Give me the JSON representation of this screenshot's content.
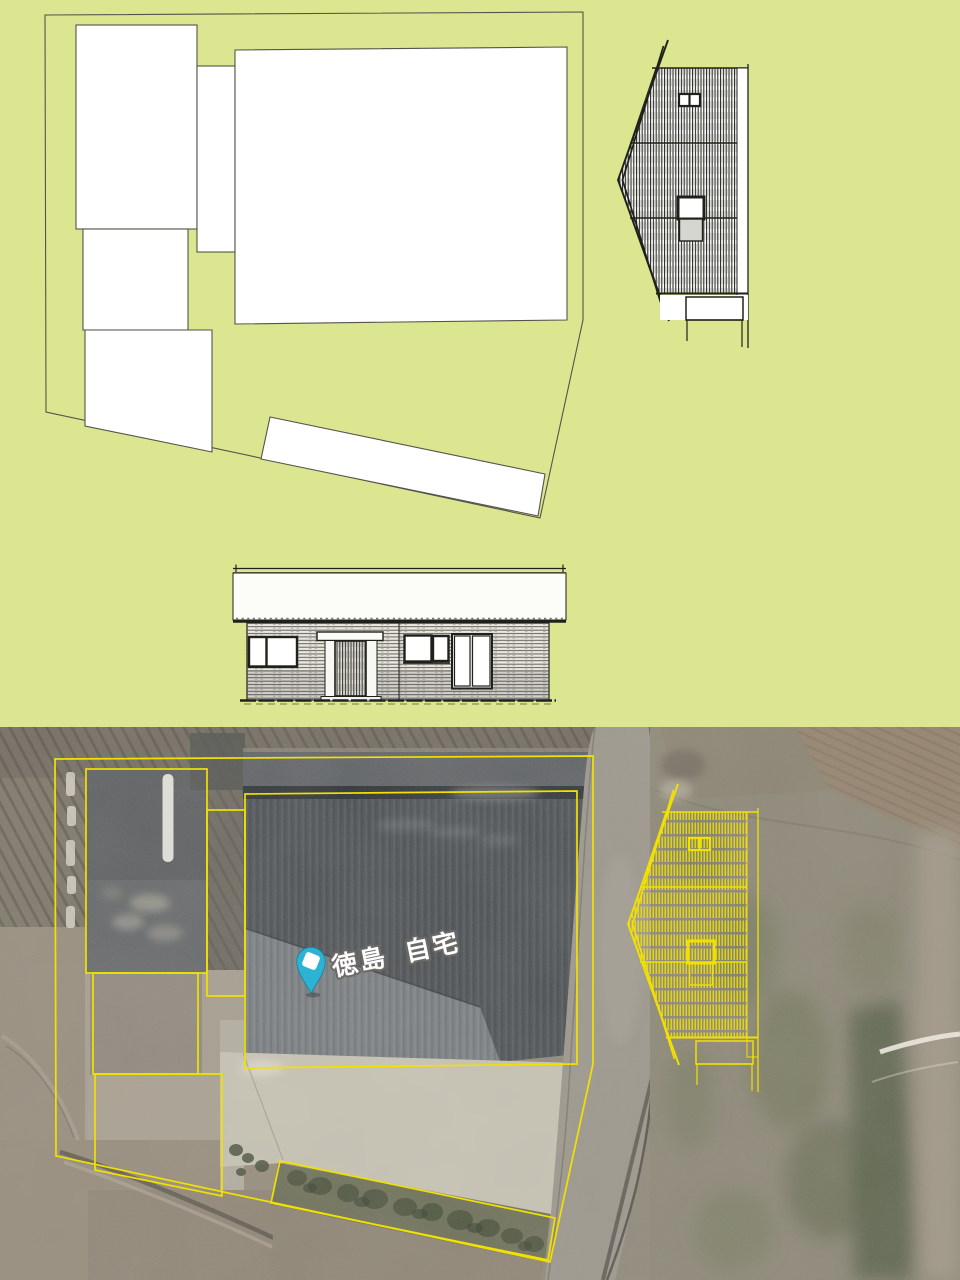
{
  "map": {
    "pin_label": "徳島 自宅"
  },
  "palette": {
    "plan_background": "#dce58f",
    "plan_line": "#54544b",
    "drawing_ink": "#21211b",
    "parcel_fill": "#ffffff",
    "overlay_yellow": "#f1e100",
    "pin_teal": "#2cb3d4",
    "label_white": "#ffffff",
    "label_outline": "#6b6a66"
  }
}
